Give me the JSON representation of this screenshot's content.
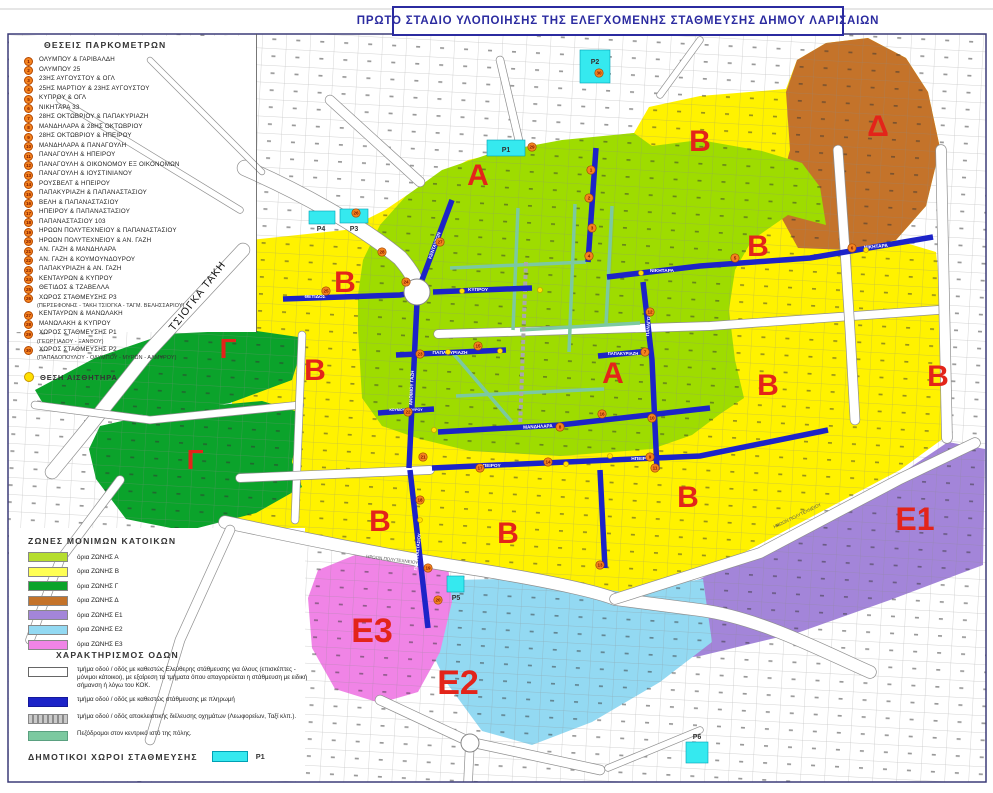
{
  "page": {
    "title": "ΠΡΩΤΟ ΣΤΑΔΙΟ ΥΛΟΠΟΙΗΣΗΣ ΤΗΣ ΕΛΕΓΧΟΜΕΝΗΣ ΣΤΑΘΜΕΥΣΗΣ ΔΗΜΟΥ ΛΑΡΙΣΑΙΩΝ"
  },
  "legend_meters": {
    "header": "ΘΕΣΕΙΣ ΠΑΡΚΟΜΕΤΡΩΝ",
    "items": [
      {
        "n": "1",
        "label": "ΟΛΥΜΠΟΥ & ΓΑΡΙΒΑΛΔΗ"
      },
      {
        "n": "2",
        "label": "ΟΛΥΜΠΟΥ 25"
      },
      {
        "n": "3",
        "label": "23ΗΣ ΑΥΓΟΥΣΤΟΥ & ΟΓΛ"
      },
      {
        "n": "4",
        "label": "25ΗΣ ΜΑΡΤΙΟΥ & 23ΗΣ ΑΥΓΟΥΣΤΟΥ"
      },
      {
        "n": "5",
        "label": "ΚΥΠΡΟΥ & ΟΓΛ"
      },
      {
        "n": "6",
        "label": "ΝΙΚΗΤΑΡΑ 33"
      },
      {
        "n": "7",
        "label": "28ΗΣ ΟΚΤΩΒΡΙΟΥ & ΠΑΠΑΚΥΡΙΑΖΗ"
      },
      {
        "n": "8",
        "label": "ΜΑΝΔΗΛΑΡΑ & 28ΗΣ ΟΚΤΩΒΡΙΟΥ"
      },
      {
        "n": "9",
        "label": "28ΗΣ ΟΚΤΩΒΡΙΟΥ & ΗΠΕΙΡΟΥ"
      },
      {
        "n": "10",
        "label": "ΜΑΝΔΗΛΑΡΑ & ΠΑΝΑΓΟΥΛΗ"
      },
      {
        "n": "11",
        "label": "ΠΑΝΑΓΟΥΛΗ & ΗΠΕΙΡΟΥ"
      },
      {
        "n": "12",
        "label": "ΠΑΝΑΓΟΥΛΗ & ΟΙΚΟΝΟΜΟΥ ΕΞ ΟΙΚΟΝΟΜΩΝ"
      },
      {
        "n": "13",
        "label": "ΠΑΝΑΓΟΥΛΗ & ΙΟΥΣΤΙΝΙΑΝΟΥ"
      },
      {
        "n": "14",
        "label": "ΡΟΥΣΒΕΛΤ & ΗΠΕΙΡΟΥ"
      },
      {
        "n": "15",
        "label": "ΠΑΠΑΚΥΡΙΑΖΗ & ΠΑΠΑΝΑΣΤΑΣΙΟΥ"
      },
      {
        "n": "16",
        "label": "ΒΕΛΗ & ΠΑΠΑΝΑΣΤΑΣΙΟΥ"
      },
      {
        "n": "17",
        "label": "ΗΠΕΙΡΟΥ & ΠΑΠΑΝΑΣΤΑΣΙΟΥ"
      },
      {
        "n": "18",
        "label": "ΠΑΠΑΝΑΣΤΑΣΙΟΥ 103"
      },
      {
        "n": "19",
        "label": "ΗΡΩΩΝ ΠΟΛΥΤΕΧΝΕΙΟΥ & ΠΑΠΑΝΑΣΤΑΣΙΟΥ"
      },
      {
        "n": "20",
        "label": "ΗΡΩΩΝ ΠΟΛΥΤΕΧΝΕΙΟΥ & ΑΝ. ΓΑΖΗ"
      },
      {
        "n": "21",
        "label": "ΑΝ. ΓΑΖΗ & ΜΑΝΔΗΛΑΡΑ"
      },
      {
        "n": "22",
        "label": "ΑΝ. ΓΑΖΗ & ΚΟΥΜΟΥΝΔΟΥΡΟΥ"
      },
      {
        "n": "23",
        "label": "ΠΑΠΑΚΥΡΙΑΖΗ & ΑΝ. ΓΑΖΗ"
      },
      {
        "n": "24",
        "label": "ΚΕΝΤΑΥΡΩΝ & ΚΥΠΡΟΥ"
      },
      {
        "n": "25",
        "label": "ΘΕΤΙΔΟΣ & ΤΖΑΒΕΛΛΑ"
      },
      {
        "n": "26",
        "label": "ΧΩΡΟΣ ΣΤΑΘΜΕΥΣΗΣ Ρ3",
        "sub": "(ΠΕΡΣΕΦΟΝΗΣ - ΤΑΚΗ ΤΣΙΟΓΚΑ - ΤΑΓΜ. ΒΕΛΗΣΣΑΡΙΟΥ)"
      },
      {
        "n": "27",
        "label": "ΚΕΝΤΑΥΡΩΝ & ΜΑΝΩΛΑΚΗ"
      },
      {
        "n": "28",
        "label": "ΜΑΝΩΛΑΚΗ & ΚΥΠΡΟΥ"
      },
      {
        "n": "29",
        "label": "ΧΩΡΟΣ ΣΤΑΘΜΕΥΣΗΣ Ρ1",
        "sub": "(ΓΕΩΡΓΙΑΔΟΥ - ΞΑΝΘΟΥ)"
      },
      {
        "n": "30",
        "label": "ΧΩΡΟΣ ΣΤΑΘΜΕΥΣΗΣ Ρ2",
        "sub": "(ΠΑΠΑΔΟΠΟΥΛΟΥ - ΟΛΥΜΠΟΥ - ΜΥΡΩΝ - ΑΛΜΥΡΟΥ)"
      }
    ]
  },
  "sensor_legend": {
    "label": "ΘΕΣΗ ΑΙΣΘΗΤΗΡΑ"
  },
  "zones_legend": {
    "header": "ΖΩΝΕΣ ΜΟΝΙΜΩΝ ΚΑΤΟΙΚΩΝ",
    "items": [
      {
        "label": "όρια ΖΩΝΗΣ Α",
        "color": "#B5DD2E"
      },
      {
        "label": "όρια ΖΩΝΗΣ Β",
        "color": "#FFFF54"
      },
      {
        "label": "όρια ΖΩΝΗΣ Γ",
        "color": "#0BA32B"
      },
      {
        "label": "όρια ΖΩΝΗΣ Δ",
        "color": "#C4732A"
      },
      {
        "label": "όρια ΖΩΝΗΣ Ε1",
        "color": "#A385D9"
      },
      {
        "label": "όρια ΖΩΝΗΣ Ε2",
        "color": "#93D9F2"
      },
      {
        "label": "όρια ΖΩΝΗΣ Ε3",
        "color": "#F084E6"
      }
    ]
  },
  "roads_legend": {
    "header": "ΧΑΡΑΚΤΗΡΙΣΜΟΣ ΟΔΩΝ",
    "items": [
      {
        "type": "free",
        "label": "τμήμα οδού / οδός με καθεστώς Ελεύθερης στάθμευσης για όλους (επισκέπτες - μόνιμοι κάτοικοι), με εξαίρεση τα τμήματα όπου απαγορεύεται η στάθμευση με ειδική σήμανση ή λόγω του ΚΟΚ."
      },
      {
        "type": "paid",
        "label": "τμήμα οδού / οδός με καθεστώς στάθμευσης με πληρωμή"
      },
      {
        "type": "bus",
        "label": "τμήμα οδού / οδός αποκλειστικής διέλευσης οχημάτων (Λεωφορείων, Ταξί κλπ.)."
      },
      {
        "type": "ped",
        "label": "Πεζόδρομοι στον κεντρικό ιστό της πόλης."
      }
    ]
  },
  "municipal_legend": {
    "header": "ΔΗΜΟΤΙΚΟΙ ΧΩΡΟΙ ΣΤΑΘΜΕΥΣΗΣ",
    "swatch_label": "P1"
  },
  "map": {
    "colors": {
      "paid": "#1C23C8",
      "ped": "#7CC9A0",
      "parking": "#35E9EF",
      "meter": "#F5831F",
      "sensor": "#FFE000",
      "zone_label": "#E3241A",
      "frame": "#3C3C78"
    },
    "zones": [
      {
        "id": "b",
        "color": "#FFF200",
        "points": "232,242 345,230 385,210 425,183 468,160 530,146 600,137 634,133 649,107 700,96 786,89 797,60 826,43 868,38 906,58 928,92 940,148 926,206 896,240 936,252 944,330 948,435 900,470 800,523 705,573 612,596 480,568 340,546 232,526"
      },
      {
        "id": "d",
        "color": "#C4732A",
        "points": "786,92 797,60 826,43 868,38 906,58 928,92 940,148 926,206 896,240 848,250 798,248 775,206 790,150"
      },
      {
        "id": "a",
        "color": "#9EDC00",
        "points": "358,330 358,295 363,260 380,225 406,196 442,170 492,153 562,140 634,133 652,146 700,140 762,151 802,163 820,187 826,225 788,215 752,240 735,270 729,310 735,360 744,398 720,414 692,435 652,449 560,456 470,451 420,439 382,426 362,398"
      },
      {
        "id": "c1",
        "color": "#0BA32B",
        "points": "35,390 95,358 165,334 250,330 305,338 292,380 230,403 160,416 95,412 45,407"
      },
      {
        "id": "c2",
        "color": "#0BA32B",
        "points": "100,426 175,409 262,401 302,413 292,462 302,487 256,513 186,531 126,519 96,479 89,449"
      },
      {
        "id": "e1",
        "color": "#A385D9",
        "points": "618,640 622,602 700,579 790,533 880,488 948,442 985,449 983,565 890,600 800,632 700,656 636,665"
      },
      {
        "id": "e2",
        "color": "#93D9F2",
        "points": "412,598 455,580 540,578 622,592 703,579 712,642 660,682 592,722 532,745 482,731 446,682 426,640"
      },
      {
        "id": "e3",
        "color": "#F084E6",
        "points": "308,598 318,570 355,555 412,552 448,566 452,602 440,652 418,692 380,703 335,689 312,648"
      }
    ],
    "masks": [
      {
        "x": 9,
        "y": 36,
        "w": 247,
        "h": 296
      },
      {
        "x": 9,
        "y": 528,
        "w": 296,
        "h": 253
      }
    ],
    "white_roads": [
      {
        "d": "M245,168 C300,192 360,225 400,258 C412,272 416,280 417,290",
        "w": 15
      },
      {
        "d": "M243,250 L150,350 L88,428 L52,472",
        "w": 13
      },
      {
        "d": "M225,522 C320,542 400,558 480,570 C560,583 600,593 615,599 L700,610 C760,618 820,650 870,672",
        "w": 12
      },
      {
        "d": "M615,599 L760,553 L900,479 L975,443",
        "w": 10
      },
      {
        "d": "M438,334 L710,326 L938,310",
        "w": 8
      },
      {
        "d": "M838,150 L845,250 L850,330 L855,420",
        "w": 9
      },
      {
        "d": "M35,405 L150,420 L300,405",
        "w": 7
      },
      {
        "d": "M302,335 L295,520",
        "w": 7
      },
      {
        "d": "M240,478 L430,470",
        "w": 8
      },
      {
        "d": "M941,150 L947,438",
        "w": 10
      },
      {
        "d": "M60,100 L240,210",
        "w": 6
      },
      {
        "d": "M150,60 L262,172",
        "w": 5
      },
      {
        "d": "M700,40 L660,95",
        "w": 6
      },
      {
        "d": "M520,145 L500,60",
        "w": 7
      },
      {
        "d": "M420,182 L330,100",
        "w": 9
      },
      {
        "d": "M120,480 L60,560 L30,640",
        "w": 8
      },
      {
        "d": "M230,530 L180,640 L150,740",
        "w": 9
      },
      {
        "d": "M380,700 L470,742 L600,770",
        "w": 9
      },
      {
        "d": "M470,742 L468,783",
        "w": 8
      },
      {
        "d": "M608,768 L700,730",
        "w": 6
      }
    ],
    "ped_roads": [
      {
        "d": "M450,268 L586,262"
      },
      {
        "d": "M520,330 L640,323"
      },
      {
        "d": "M518,208 L513,330"
      },
      {
        "d": "M575,204 L569,352"
      },
      {
        "d": "M612,206 L606,324"
      },
      {
        "d": "M452,352 L512,422"
      },
      {
        "d": "M456,396 L604,389"
      }
    ],
    "bus_roads": [
      {
        "d": "M526,262 L520,430"
      }
    ],
    "blue_roads": [
      {
        "d": "M283,299 L400,295 L418,292"
      },
      {
        "d": "M433,292 L532,288"
      },
      {
        "d": "M419,288 L452,200"
      },
      {
        "d": "M417,302 L409,468"
      },
      {
        "d": "M410,470 L428,628"
      },
      {
        "d": "M396,355 L506,350"
      },
      {
        "d": "M598,356 L650,351"
      },
      {
        "d": "M643,282 L652,360 L657,470"
      },
      {
        "d": "M607,277 L700,266 L810,258 L933,237"
      },
      {
        "d": "M432,468 L700,456 L828,430"
      },
      {
        "d": "M438,432 L560,425 L710,408"
      },
      {
        "d": "M378,413 L434,409"
      },
      {
        "d": "M596,148 L588,262"
      },
      {
        "d": "M600,470 L605,568"
      }
    ],
    "street_labels": [
      {
        "t": "ΘΕΤΙΔΟΣ",
        "x": 315,
        "y": 298,
        "s": 4.8
      },
      {
        "t": "ΚΥΠΡΟΥ",
        "x": 478,
        "y": 291,
        "s": 4.8
      },
      {
        "t": "ΚΕΝΤΑΥΡΩΝ",
        "x": 436,
        "y": 246,
        "s": 4.6,
        "rot": -70
      },
      {
        "t": "ΑΝΘΙΜΟΥ ΓΑΖΗ",
        "x": 413,
        "y": 388,
        "s": 4.6,
        "rot": -87
      },
      {
        "t": "ΠΑΠΑΝΑΣΤΑΣΙΟΥ",
        "x": 419,
        "y": 552,
        "s": 4.4,
        "rot": -84
      },
      {
        "t": "ΠΑΠΑΚΥΡΙΑΖΗ",
        "x": 450,
        "y": 354,
        "s": 4.8
      },
      {
        "t": "ΠΑΠΑΚΥΡΙΑΖΗ",
        "x": 623,
        "y": 355,
        "s": 4.2
      },
      {
        "t": "ΠΑΝΑΓΟΥΛΗ",
        "x": 650,
        "y": 322,
        "s": 4.6,
        "rot": -86
      },
      {
        "t": "ΝΙΚΗΤΑΡΑ",
        "x": 662,
        "y": 272,
        "s": 4.8
      },
      {
        "t": "ΝΙΚΗΤΑΡΑ",
        "x": 876,
        "y": 248,
        "s": 4.8,
        "rot": -5
      },
      {
        "t": "ΗΠΕΙΡΟΥ",
        "x": 490,
        "y": 467,
        "s": 4.8
      },
      {
        "t": "ΗΠΕΙΡΟΥ",
        "x": 642,
        "y": 460,
        "s": 4.8
      },
      {
        "t": "ΜΑΝΔΗΛΑΡΑ",
        "x": 538,
        "y": 428,
        "s": 4.6,
        "rot": -3
      },
      {
        "t": "ΚΟΥΜΟΥΝΔΟΥΡΟΥ",
        "x": 406,
        "y": 411,
        "s": 3.6
      }
    ],
    "texts": [
      {
        "t": "ΤΣΙΟΓΚΑ ΤΑΚΗ",
        "x": 200,
        "y": 298,
        "s": 10.5,
        "rot": -52,
        "fill": "#111",
        "ls": 1
      },
      {
        "t": "ΗΡΩΩΝ ΠΟΛΥΤΕΧΝΕΙΟΥ",
        "x": 392,
        "y": 561,
        "s": 4.5,
        "rot": 7,
        "fill": "#555"
      },
      {
        "t": "ΗΡΩΩΝ ΠΟΛΥΤΕΧΝΕΙΟΥ",
        "x": 798,
        "y": 517,
        "s": 4.5,
        "rot": -26,
        "fill": "#555"
      }
    ],
    "zone_labels": [
      {
        "t": "Α",
        "x": 478,
        "y": 185,
        "s": 30
      },
      {
        "t": "Α",
        "x": 613,
        "y": 383,
        "s": 30
      },
      {
        "t": "Β",
        "x": 345,
        "y": 292,
        "s": 30
      },
      {
        "t": "Β",
        "x": 700,
        "y": 151,
        "s": 30
      },
      {
        "t": "Β",
        "x": 758,
        "y": 256,
        "s": 30
      },
      {
        "t": "Β",
        "x": 315,
        "y": 380,
        "s": 30
      },
      {
        "t": "Β",
        "x": 768,
        "y": 395,
        "s": 30
      },
      {
        "t": "Β",
        "x": 938,
        "y": 386,
        "s": 30
      },
      {
        "t": "Β",
        "x": 380,
        "y": 531,
        "s": 30
      },
      {
        "t": "Β",
        "x": 508,
        "y": 543,
        "s": 30
      },
      {
        "t": "Β",
        "x": 688,
        "y": 507,
        "s": 30
      },
      {
        "t": "Γ",
        "x": 228,
        "y": 358,
        "s": 28
      },
      {
        "t": "Γ",
        "x": 195,
        "y": 469,
        "s": 28
      },
      {
        "t": "Δ",
        "x": 878,
        "y": 136,
        "s": 30
      },
      {
        "t": "Ε1",
        "x": 915,
        "y": 530,
        "s": 32
      },
      {
        "t": "Ε2",
        "x": 458,
        "y": 694,
        "s": 34
      },
      {
        "t": "Ε3",
        "x": 372,
        "y": 642,
        "s": 34
      }
    ],
    "parkings": [
      {
        "label": "P1",
        "x": 487,
        "y": 140,
        "w": 38,
        "h": 16,
        "lx": 506,
        "ly": 152
      },
      {
        "label": "P2",
        "x": 580,
        "y": 50,
        "w": 30,
        "h": 33,
        "lx": 595,
        "ly": 64
      },
      {
        "label": "P3",
        "x": 340,
        "y": 209,
        "w": 28,
        "h": 14,
        "lx": 354,
        "ly": 231
      },
      {
        "label": "P4",
        "x": 309,
        "y": 211,
        "w": 26,
        "h": 13,
        "lx": 321,
        "ly": 231
      },
      {
        "label": "P5",
        "x": 447,
        "y": 576,
        "w": 17,
        "h": 16,
        "lx": 456,
        "ly": 600
      },
      {
        "label": "P6",
        "x": 686,
        "y": 742,
        "w": 22,
        "h": 21,
        "lx": 697,
        "ly": 739
      }
    ],
    "circles": [
      {
        "x": 417,
        "y": 292,
        "r": 13
      },
      {
        "x": 470,
        "y": 743,
        "r": 9
      }
    ],
    "meters": [
      {
        "n": "1",
        "x": 591,
        "y": 170
      },
      {
        "n": "2",
        "x": 589,
        "y": 198
      },
      {
        "n": "3",
        "x": 592,
        "y": 228
      },
      {
        "n": "4",
        "x": 589,
        "y": 256
      },
      {
        "n": "5",
        "x": 735,
        "y": 258
      },
      {
        "n": "6",
        "x": 852,
        "y": 248
      },
      {
        "n": "7",
        "x": 645,
        "y": 352
      },
      {
        "n": "8",
        "x": 560,
        "y": 427
      },
      {
        "n": "9",
        "x": 650,
        "y": 457
      },
      {
        "n": "10",
        "x": 652,
        "y": 418
      },
      {
        "n": "11",
        "x": 655,
        "y": 468
      },
      {
        "n": "12",
        "x": 650,
        "y": 312
      },
      {
        "n": "13",
        "x": 600,
        "y": 565
      },
      {
        "n": "14",
        "x": 548,
        "y": 462
      },
      {
        "n": "15",
        "x": 478,
        "y": 346
      },
      {
        "n": "16",
        "x": 602,
        "y": 414
      },
      {
        "n": "17",
        "x": 480,
        "y": 468
      },
      {
        "n": "18",
        "x": 420,
        "y": 500
      },
      {
        "n": "19",
        "x": 428,
        "y": 568
      },
      {
        "n": "20",
        "x": 438,
        "y": 600
      },
      {
        "n": "21",
        "x": 423,
        "y": 457
      },
      {
        "n": "22",
        "x": 408,
        "y": 412
      },
      {
        "n": "23",
        "x": 420,
        "y": 354
      },
      {
        "n": "24",
        "x": 406,
        "y": 282
      },
      {
        "n": "25",
        "x": 326,
        "y": 291
      },
      {
        "n": "26",
        "x": 356,
        "y": 213
      },
      {
        "n": "27",
        "x": 440,
        "y": 242
      },
      {
        "n": "28",
        "x": 382,
        "y": 252
      },
      {
        "n": "29",
        "x": 532,
        "y": 147
      },
      {
        "n": "30",
        "x": 599,
        "y": 73
      }
    ],
    "sensors": [
      {
        "x": 462,
        "y": 291
      },
      {
        "x": 500,
        "y": 351
      },
      {
        "x": 434,
        "y": 430
      },
      {
        "x": 566,
        "y": 464
      },
      {
        "x": 641,
        "y": 273
      },
      {
        "x": 420,
        "y": 520
      },
      {
        "x": 610,
        "y": 456
      },
      {
        "x": 866,
        "y": 250
      },
      {
        "x": 448,
        "y": 352
      },
      {
        "x": 540,
        "y": 290
      }
    ],
    "frame": {
      "x": 8,
      "y": 34,
      "w": 978,
      "h": 748
    }
  }
}
